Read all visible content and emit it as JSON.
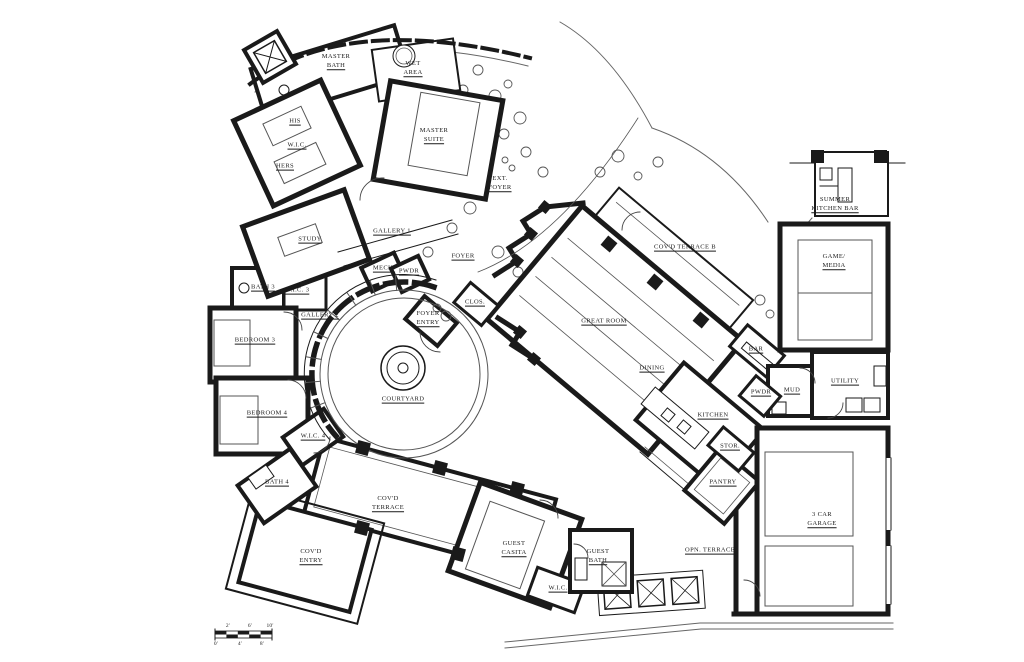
{
  "page": {
    "background": "#ffffff",
    "ink_color": "#1a1a1a",
    "thin_line_color": "#555555"
  },
  "plan": {
    "type": "architectural-floor-plan",
    "rooms": [
      {
        "name": "master-bath",
        "x": 336,
        "y": 62,
        "lines": [
          "MASTER",
          "BATH"
        ]
      },
      {
        "name": "wet-area",
        "x": 413,
        "y": 69,
        "lines": [
          "WET",
          "AREA"
        ]
      },
      {
        "name": "his-closet",
        "x": 295,
        "y": 122,
        "lines": [
          "HIS"
        ]
      },
      {
        "name": "master-wic",
        "x": 297,
        "y": 146,
        "lines": [
          "W.I.C."
        ]
      },
      {
        "name": "hers-closet",
        "x": 285,
        "y": 167,
        "lines": [
          "HERS"
        ]
      },
      {
        "name": "master-suite",
        "x": 434,
        "y": 136,
        "lines": [
          "MASTER",
          "SUITE"
        ]
      },
      {
        "name": "ext-foyer",
        "x": 500,
        "y": 184,
        "lines": [
          "EXT.",
          "FOYER"
        ]
      },
      {
        "name": "study",
        "x": 310,
        "y": 240,
        "lines": [
          "STUDY"
        ]
      },
      {
        "name": "gallery-1",
        "x": 392,
        "y": 232,
        "lines": [
          "GALLERY 1"
        ]
      },
      {
        "name": "foyer",
        "x": 463,
        "y": 257,
        "lines": [
          "FOYER"
        ]
      },
      {
        "name": "mech",
        "x": 384,
        "y": 269,
        "lines": [
          "MECH."
        ]
      },
      {
        "name": "pwdr-foyer",
        "x": 409,
        "y": 272,
        "lines": [
          "PWDR"
        ]
      },
      {
        "name": "bath-3",
        "x": 263,
        "y": 288,
        "lines": [
          "BATH 3"
        ]
      },
      {
        "name": "wic-3",
        "x": 297,
        "y": 291,
        "lines": [
          "W.I.C. 3"
        ]
      },
      {
        "name": "gallery-2",
        "x": 320,
        "y": 316,
        "lines": [
          "GALLERY 2"
        ]
      },
      {
        "name": "closet",
        "x": 475,
        "y": 303,
        "lines": [
          "CLOS."
        ]
      },
      {
        "name": "foyer-entry",
        "x": 428,
        "y": 319,
        "lines": [
          "FOYER",
          "ENTRY"
        ]
      },
      {
        "name": "bedroom-3",
        "x": 255,
        "y": 341,
        "lines": [
          "BEDROOM 3"
        ]
      },
      {
        "name": "courtyard",
        "x": 403,
        "y": 400,
        "lines": [
          "COURTYARD"
        ]
      },
      {
        "name": "bedroom-4",
        "x": 267,
        "y": 414,
        "lines": [
          "BEDROOM 4"
        ]
      },
      {
        "name": "wic-4",
        "x": 313,
        "y": 437,
        "lines": [
          "W.I.C. 4"
        ]
      },
      {
        "name": "bath-4",
        "x": 277,
        "y": 483,
        "lines": [
          "BATH 4"
        ]
      },
      {
        "name": "covd-terrace",
        "x": 388,
        "y": 504,
        "lines": [
          "COV'D",
          "TERRACE"
        ]
      },
      {
        "name": "covd-entry",
        "x": 311,
        "y": 557,
        "lines": [
          "COV'D",
          "ENTRY"
        ]
      },
      {
        "name": "guest-casita",
        "x": 514,
        "y": 549,
        "lines": [
          "GUEST",
          "CASITA"
        ]
      },
      {
        "name": "guest-bath",
        "x": 598,
        "y": 557,
        "lines": [
          "GUEST",
          "BATH"
        ]
      },
      {
        "name": "guest-wic",
        "x": 558,
        "y": 589,
        "lines": [
          "W.I.C."
        ]
      },
      {
        "name": "great-room",
        "x": 604,
        "y": 322,
        "lines": [
          "GREAT ROOM"
        ]
      },
      {
        "name": "dining",
        "x": 652,
        "y": 369,
        "lines": [
          "DINING"
        ]
      },
      {
        "name": "covd-terrace-b",
        "x": 685,
        "y": 248,
        "lines": [
          "COV'D TERRACE B"
        ]
      },
      {
        "name": "summer-kitchen-bar",
        "x": 835,
        "y": 205,
        "lines": [
          "SUMMER",
          "KITCHEN BAR"
        ]
      },
      {
        "name": "game-media",
        "x": 834,
        "y": 262,
        "lines": [
          "GAME/",
          "MEDIA"
        ]
      },
      {
        "name": "bar",
        "x": 756,
        "y": 350,
        "lines": [
          "BAR"
        ]
      },
      {
        "name": "utility",
        "x": 845,
        "y": 382,
        "lines": [
          "UTILITY"
        ]
      },
      {
        "name": "mud",
        "x": 792,
        "y": 391,
        "lines": [
          "MUD"
        ]
      },
      {
        "name": "pwdr-mud",
        "x": 761,
        "y": 393,
        "lines": [
          "PWDR"
        ]
      },
      {
        "name": "kitchen",
        "x": 713,
        "y": 416,
        "lines": [
          "KITCHEN"
        ]
      },
      {
        "name": "stor",
        "x": 730,
        "y": 447,
        "lines": [
          "STOR."
        ]
      },
      {
        "name": "pantry",
        "x": 723,
        "y": 483,
        "lines": [
          "PANTRY"
        ]
      },
      {
        "name": "opn-terrace",
        "x": 710,
        "y": 551,
        "lines": [
          "OPN. TERRACE"
        ]
      },
      {
        "name": "three-car-garage",
        "x": 822,
        "y": 520,
        "lines": [
          "3 CAR",
          "GARAGE"
        ]
      }
    ],
    "scale_bar": {
      "labels": [
        {
          "text": "2'",
          "x": 228,
          "y": 626
        },
        {
          "text": "6'",
          "x": 250,
          "y": 626
        },
        {
          "text": "10'",
          "x": 270,
          "y": 626
        },
        {
          "text": "0'",
          "x": 216,
          "y": 644
        },
        {
          "text": "4'",
          "x": 240,
          "y": 644
        },
        {
          "text": "8'",
          "x": 262,
          "y": 644
        }
      ]
    }
  }
}
